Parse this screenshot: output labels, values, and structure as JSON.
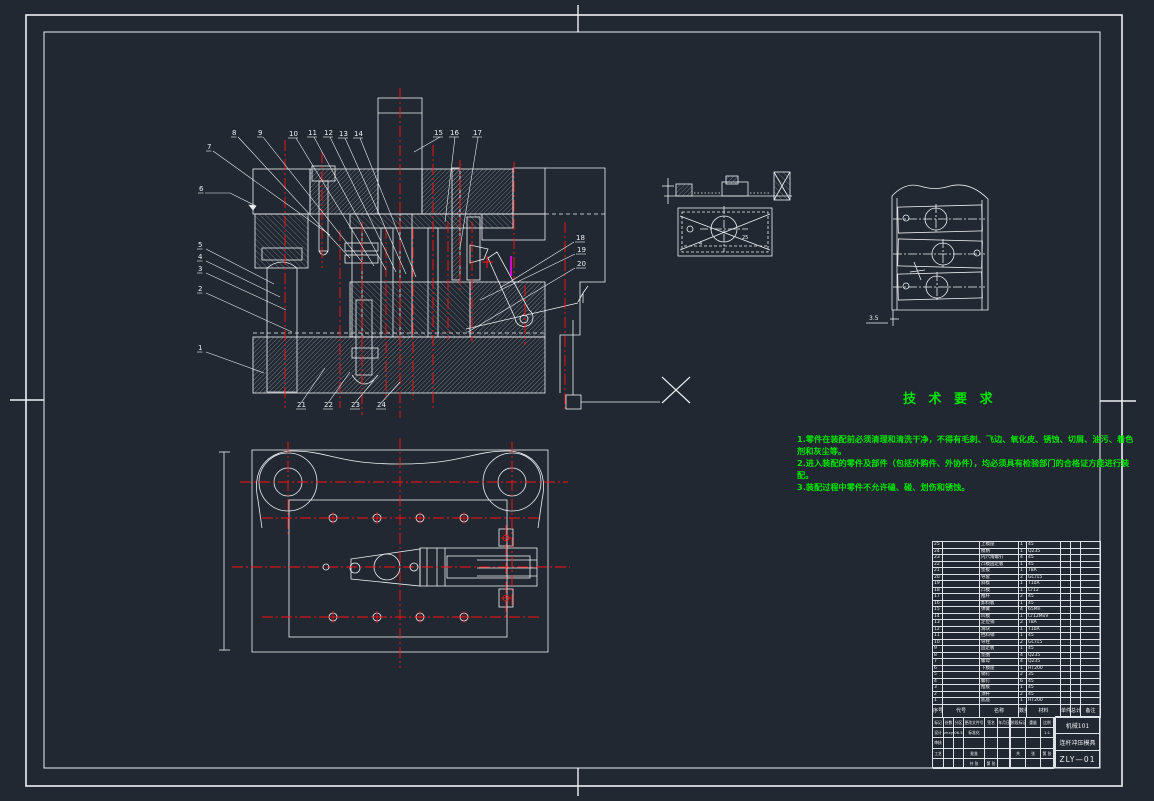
{
  "colors": {
    "background": "#222831",
    "line": "#eef1f4",
    "centerline": "#ff1111",
    "notes_green": "#00e400",
    "accent_magenta": "#ff00ff"
  },
  "tech": {
    "title": "技 术 要 求",
    "lines": [
      "1.零件在装配前必须清理和清洗干净，不得有毛刺、飞边、氧化皮、锈蚀、切屑、油污、着色",
      "剂和灰尘等。",
      "2.进入装配的零件及部件（包括外购件、外协件），均必须具有检验部门的合格证方能进行装",
      "配。",
      "3.装配过程中零件不允许磕、碰、划伤和锈蚀。"
    ]
  },
  "balloons": [
    {
      "t": "7",
      "x": 207,
      "y": 149
    },
    {
      "t": "8",
      "x": 232,
      "y": 135
    },
    {
      "t": "9",
      "x": 258,
      "y": 135
    },
    {
      "t": "10",
      "x": 289,
      "y": 136
    },
    {
      "t": "11",
      "x": 308,
      "y": 135
    },
    {
      "t": "12",
      "x": 324,
      "y": 135
    },
    {
      "t": "13",
      "x": 339,
      "y": 136
    },
    {
      "t": "14",
      "x": 354,
      "y": 136
    },
    {
      "t": "15",
      "x": 434,
      "y": 135
    },
    {
      "t": "16",
      "x": 450,
      "y": 135
    },
    {
      "t": "17",
      "x": 473,
      "y": 135
    },
    {
      "t": "6",
      "x": 199,
      "y": 191
    },
    {
      "t": "5",
      "x": 198,
      "y": 247
    },
    {
      "t": "4",
      "x": 198,
      "y": 259
    },
    {
      "t": "3",
      "x": 198,
      "y": 271
    },
    {
      "t": "2",
      "x": 198,
      "y": 291
    },
    {
      "t": "1",
      "x": 198,
      "y": 350
    },
    {
      "t": "18",
      "x": 576,
      "y": 240
    },
    {
      "t": "19",
      "x": 577,
      "y": 252
    },
    {
      "t": "20",
      "x": 577,
      "y": 266
    },
    {
      "t": "21",
      "x": 297,
      "y": 407
    },
    {
      "t": "22",
      "x": 324,
      "y": 407
    },
    {
      "t": "23",
      "x": 351,
      "y": 407
    },
    {
      "t": "24",
      "x": 377,
      "y": 407
    }
  ],
  "dims": [
    {
      "t": "4",
      "x": 699,
      "y": 245,
      "s": 5
    },
    {
      "t": "25",
      "x": 742,
      "y": 239,
      "s": 5
    },
    {
      "t": "3.5",
      "x": 869,
      "y": 320,
      "s": 6
    }
  ],
  "bom": {
    "headers": [
      "序号",
      "代号",
      "名称",
      "数量",
      "材料",
      "单件",
      "总计",
      "备注"
    ],
    "rows": [
      [
        "25",
        "",
        "上模座",
        "1",
        "45",
        "",
        "",
        ""
      ],
      [
        "24",
        "",
        "模柄",
        "1",
        "Q235",
        "",
        "",
        ""
      ],
      [
        "23",
        "",
        "内六角螺钉",
        "4",
        "45",
        "",
        "",
        ""
      ],
      [
        "22",
        "",
        "凸模固定板",
        "1",
        "45",
        "",
        "",
        ""
      ],
      [
        "21",
        "",
        "垫板",
        "1",
        "T8A",
        "",
        "",
        ""
      ],
      [
        "20",
        "",
        "导套",
        "2",
        "GCr15",
        "",
        "",
        ""
      ],
      [
        "19",
        "",
        "斜楔",
        "1",
        "T10A",
        "",
        "",
        ""
      ],
      [
        "18",
        "",
        "凸模",
        "1",
        "Cr12",
        "",
        "",
        ""
      ],
      [
        "17",
        "",
        "推杆",
        "2",
        "45",
        "",
        "",
        ""
      ],
      [
        "16",
        "",
        "卸料板",
        "1",
        "45",
        "",
        "",
        ""
      ],
      [
        "15",
        "",
        "弹簧",
        "4",
        "65Mn",
        "",
        "",
        ""
      ],
      [
        "14",
        "",
        "凹模",
        "1",
        "Cr12MoV",
        "",
        "",
        ""
      ],
      [
        "13",
        "",
        "定位销",
        "2",
        "T8A",
        "",
        "",
        ""
      ],
      [
        "12",
        "",
        "滑块",
        "1",
        "T10A",
        "",
        "",
        ""
      ],
      [
        "11",
        "",
        "挡料销",
        "1",
        "45",
        "",
        "",
        ""
      ],
      [
        "10",
        "",
        "导柱",
        "2",
        "GCr15",
        "",
        "",
        ""
      ],
      [
        "9",
        "",
        "固定板",
        "1",
        "45",
        "",
        "",
        ""
      ],
      [
        "8",
        "",
        "垫圈",
        "4",
        "Q235",
        "",
        "",
        ""
      ],
      [
        "7",
        "",
        "螺母",
        "4",
        "Q235",
        "",
        "",
        ""
      ],
      [
        "6",
        "",
        "下模座",
        "1",
        "HT200",
        "",
        "",
        ""
      ],
      [
        "5",
        "",
        "销钉",
        "2",
        "35",
        "",
        "",
        ""
      ],
      [
        "4",
        "",
        "螺钉",
        "6",
        "45",
        "",
        "",
        ""
      ],
      [
        "3",
        "",
        "推板",
        "1",
        "45",
        "",
        "",
        ""
      ],
      [
        "2",
        "",
        "顶杆",
        "2",
        "45",
        "",
        "",
        ""
      ],
      [
        "1",
        "",
        "底座",
        "1",
        "HT200",
        "",
        "",
        ""
      ]
    ]
  },
  "titleblock": {
    "sig_cells": [
      "标记",
      "处数",
      "分区",
      "更改文件号",
      "签名",
      "年月日",
      "设计",
      "zhxy",
      "06.5",
      "标准化",
      "",
      "",
      "审核",
      "",
      "",
      "",
      "",
      "",
      "工艺",
      "",
      "",
      "批准",
      "",
      "",
      "",
      "",
      "",
      "共 张",
      "第 张",
      ""
    ],
    "stage_cells": [
      "阶段标记",
      "重量",
      "比例",
      "",
      "",
      "1:1",
      "",
      "",
      "",
      "共",
      "张",
      "第 张",
      "",
      "",
      ""
    ],
    "org": "机械101",
    "drawing_title": "连杆冲压模具",
    "drawing_no": "ZLY—01"
  }
}
